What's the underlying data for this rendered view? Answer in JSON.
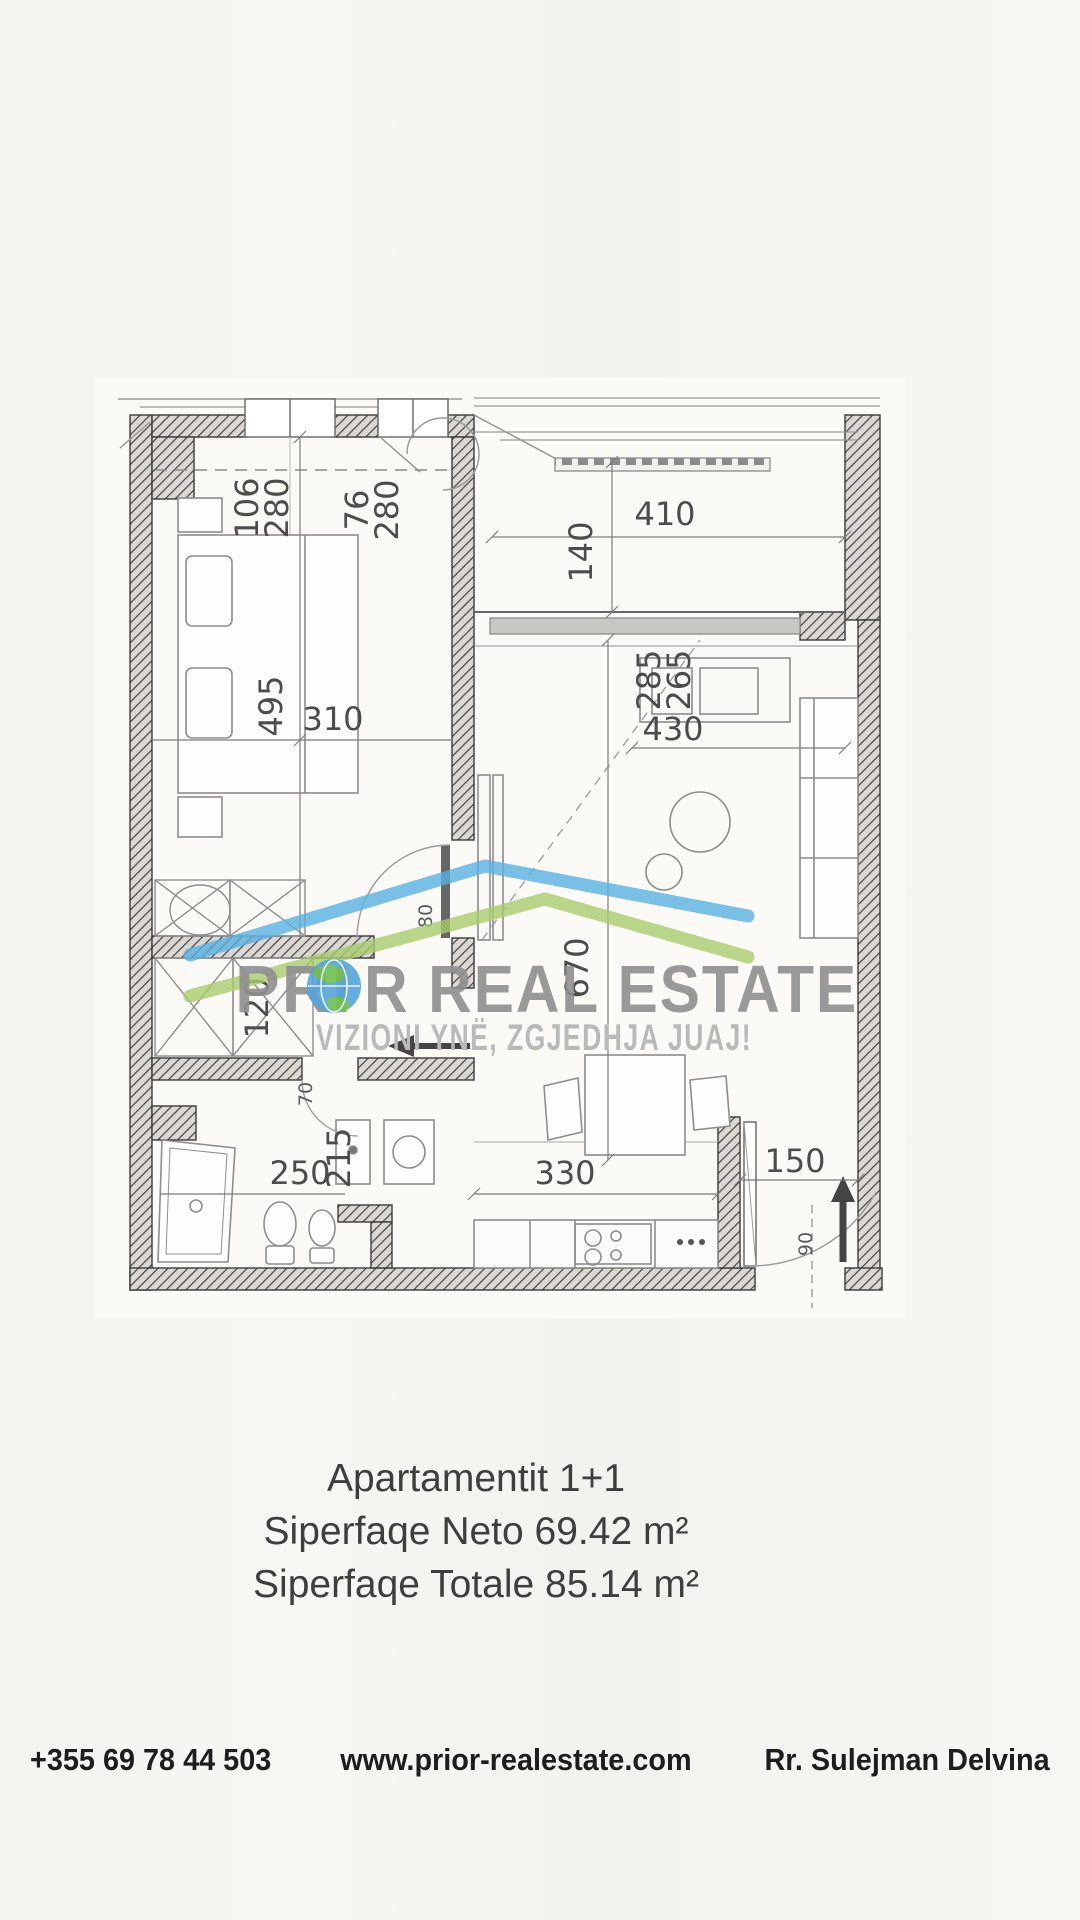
{
  "plan": {
    "watermark": {
      "brand_pre": "PRI",
      "brand_post": "R REAL ESTATE",
      "tagline": "VIZIONI YNË, ZGJEDHJA JUAJ!"
    },
    "dims": {
      "window_left_w": "106",
      "window_left_h": "280",
      "window_mid_w": "76",
      "window_mid_h": "280",
      "balcony_width": "410",
      "balcony_depth": "140",
      "living_window_a": "285",
      "living_window_b": "265",
      "living_width": "430",
      "bedroom_length": "495",
      "bedroom_width": "310",
      "living_length": "670",
      "closet_width": "120",
      "bedroom_door": "80",
      "bath_width": "250",
      "bath_length": "215",
      "kitchen_width": "330",
      "entry_width": "150",
      "bath_door": "70",
      "entry_door": "90"
    }
  },
  "info": {
    "line1": "Apartamentit 1+1",
    "line2": "Siperfaqe Neto 69.42 m²",
    "line3": "Siperfaqe Totale 85.14 m²"
  },
  "footer": {
    "phone": "+355 69 78 44 503",
    "website": "www.prior-realestate.com",
    "address": "Rr. Sulejman Delvina"
  },
  "colors": {
    "roof_blue": "#58b2e0",
    "roof_green": "#a7cc6c",
    "watermark_gray": "#8f8f8f",
    "tagline_gray": "#b9b9b9",
    "globe_blue": "#55a5da",
    "globe_green": "#6fbf4e",
    "text_dark": "#3e3e3e",
    "footer_dark": "#1d1d1d"
  }
}
